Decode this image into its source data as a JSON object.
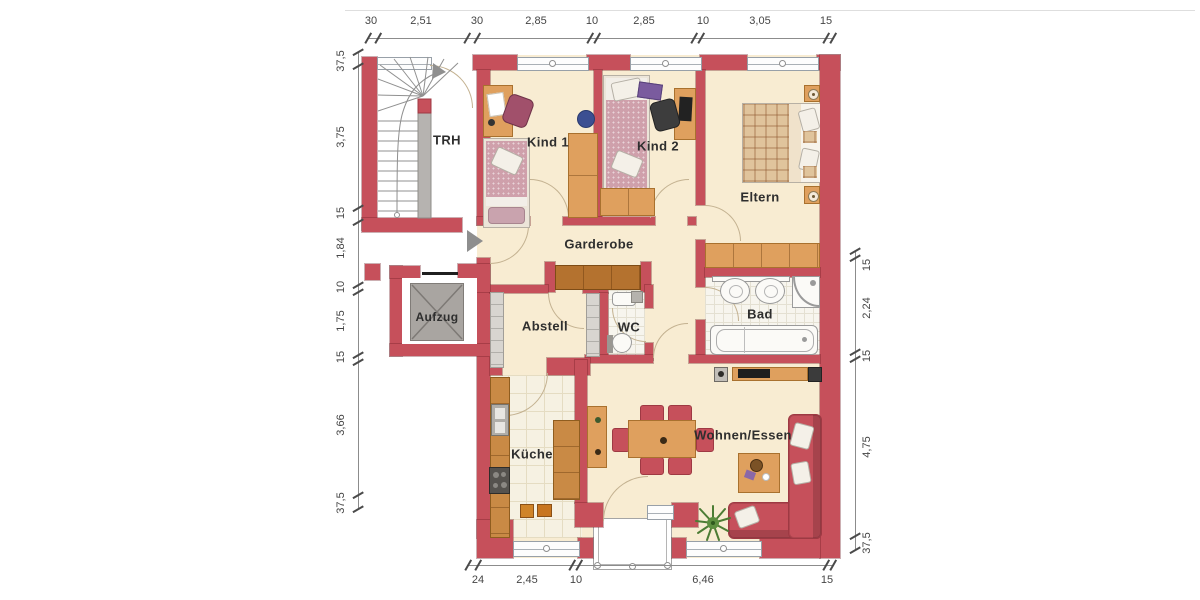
{
  "rooms": {
    "trh": "TRH",
    "aufzug": "Aufzug",
    "kind1": "Kind 1",
    "kind2": "Kind 2",
    "eltern": "Eltern",
    "garderobe": "Garderobe",
    "abstell": "Abstell",
    "wc": "WC",
    "bad": "Bad",
    "kueche": "Küche",
    "wohnen": "Wohnen/Essen"
  },
  "dimensions": {
    "top": {
      "values": [
        "30",
        "2,51",
        "30",
        "2,85",
        "10",
        "2,85",
        "10",
        "3,05",
        "15"
      ]
    },
    "left": {
      "values": [
        "37,5",
        "3,75",
        "15",
        "1,84",
        "10",
        "1,75",
        "15",
        "3,66",
        "37,5"
      ]
    },
    "right": {
      "values": [
        "15",
        "2,24",
        "15",
        "4,75",
        "37,5"
      ]
    },
    "bottom": {
      "values": [
        "24",
        "2,45",
        "10",
        "6,46",
        "15"
      ]
    }
  },
  "colors": {
    "wall": "#c6505b",
    "floor": "#f8ecd2",
    "wood": "#dfa05e",
    "wood_dark": "#b4722f",
    "counter": "#c98a45",
    "gray_furniture": "#b6b3b0",
    "sofa": "#c6505b",
    "dimension_text": "#454545",
    "label_text": "#2e2e2e"
  }
}
